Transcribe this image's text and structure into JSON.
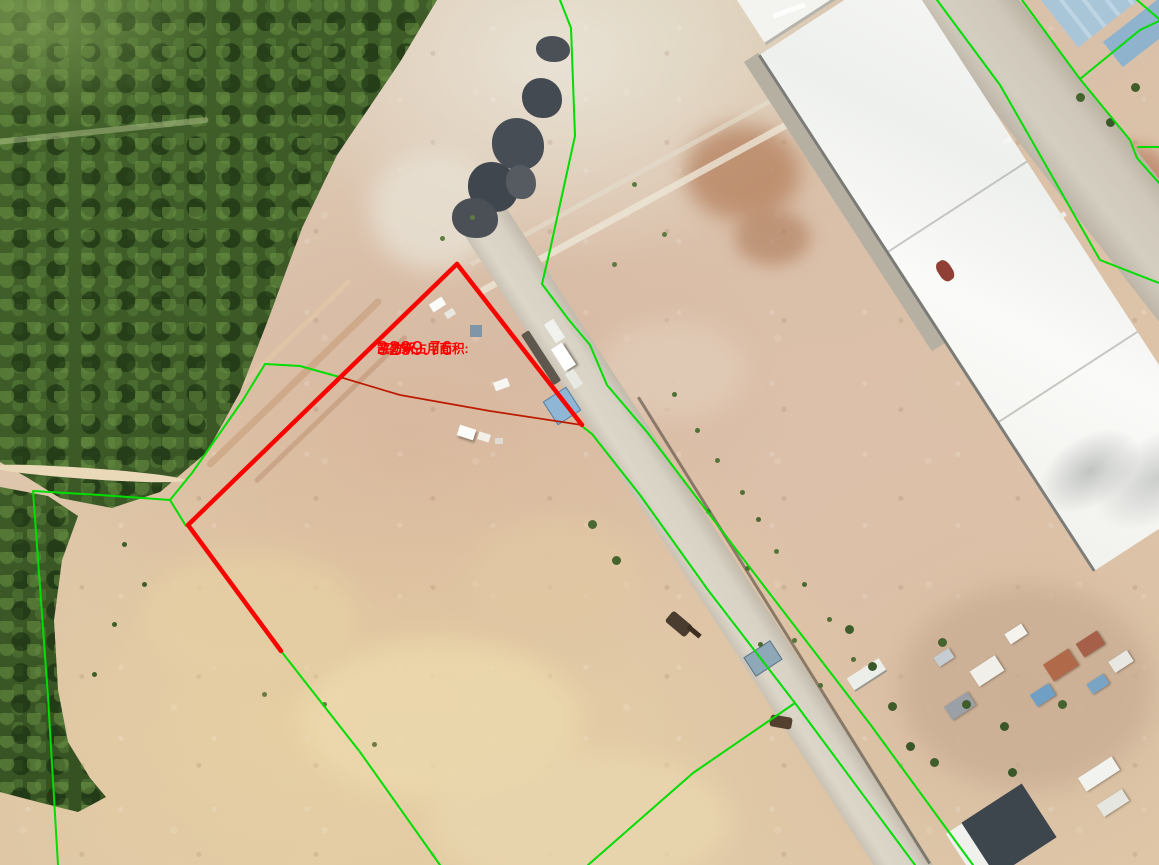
{
  "map": {
    "label": {
      "prefix": "凯勒斯占用面积:",
      "area": "3299.76",
      "unit": "平方米"
    },
    "overlay": {
      "boundary_green": "#00dd00",
      "highlight_red": "#f80400",
      "parcel_thin_red": "#bb1a00",
      "label_red": "#fa0000"
    }
  }
}
